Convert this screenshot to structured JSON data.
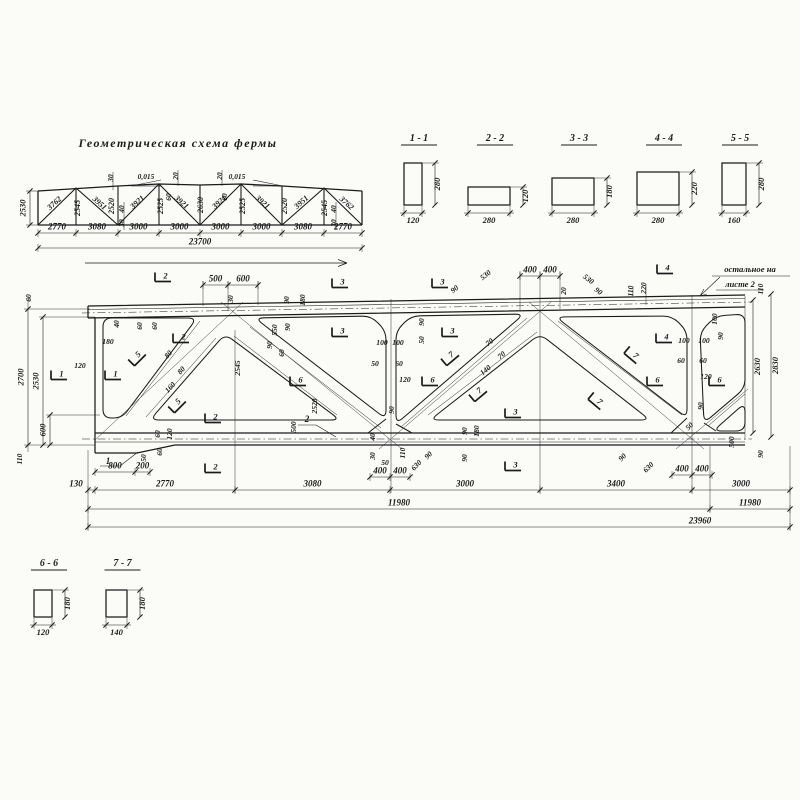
{
  "palette": {
    "paper": "#fbfbf8",
    "ink": "#1b1b1b"
  },
  "scheme": {
    "title": "Геометрическая схема фермы",
    "member_labels": [
      [
        "3762",
        56,
        205,
        -42
      ],
      [
        "2545",
        80,
        208,
        -90
      ],
      [
        "3951",
        98,
        205,
        42
      ],
      [
        "2520",
        114,
        206,
        -90
      ],
      [
        "3921",
        139,
        204,
        -42
      ],
      [
        "2525",
        163,
        206,
        -90
      ],
      [
        "3921",
        180,
        204,
        42
      ],
      [
        "2630",
        203,
        205,
        -90
      ],
      [
        "3921",
        221,
        204,
        -42
      ],
      [
        "2525",
        245,
        206,
        -90
      ],
      [
        "3921",
        261,
        204,
        42
      ],
      [
        "2520",
        287,
        206,
        -90
      ],
      [
        "3951",
        303,
        204,
        -42
      ],
      [
        "2545",
        327,
        208,
        -90
      ],
      [
        "3762",
        345,
        205,
        42
      ]
    ],
    "small_dims": [
      [
        "30",
        113,
        178,
        -90
      ],
      [
        "0,015",
        146,
        179
      ],
      [
        "20",
        178,
        176,
        -90
      ],
      [
        "60",
        171,
        197,
        -90
      ],
      [
        "20",
        222,
        176,
        -90
      ],
      [
        "0,015",
        237,
        179
      ],
      [
        "60",
        227,
        197,
        -90
      ],
      [
        "40",
        124,
        209,
        -90
      ],
      [
        "30",
        124,
        223,
        -90
      ],
      [
        "40",
        336,
        209,
        -90
      ],
      [
        "30",
        336,
        223,
        -90
      ]
    ],
    "dimrows": [
      {
        "y": 233,
        "ticks": [
          38,
          76,
          118,
          159,
          200,
          241,
          282,
          324,
          362
        ],
        "labels": [
          "2770",
          "3080",
          "3000",
          "3000",
          "3000",
          "3000",
          "3080",
          "2770"
        ]
      },
      {
        "y": 248,
        "ticks": [
          38,
          362
        ],
        "labels": [
          "23700"
        ]
      }
    ],
    "vdims": [
      {
        "x": 30,
        "y1": 191,
        "y2": 225,
        "t": "2530"
      }
    ]
  },
  "sections": [
    {
      "name": "1 - 1",
      "w": "120",
      "h": "280",
      "px": {
        "x": 404,
        "y": 163,
        "w": 18,
        "h": 42,
        "hx": 141
      }
    },
    {
      "name": "2 - 2",
      "w": "280",
      "h": "120",
      "px": {
        "x": 468,
        "y": 187,
        "w": 42,
        "h": 18,
        "hx": 141
      }
    },
    {
      "name": "3 - 3",
      "w": "280",
      "h": "180",
      "px": {
        "x": 552,
        "y": 178,
        "w": 42,
        "h": 27,
        "hx": 141
      }
    },
    {
      "name": "4 - 4",
      "w": "280",
      "h": "220",
      "px": {
        "x": 637,
        "y": 172,
        "w": 42,
        "h": 33,
        "hx": 141
      }
    },
    {
      "name": "5 - 5",
      "w": "160",
      "h": "280",
      "px": {
        "x": 722,
        "y": 163,
        "w": 24,
        "h": 42,
        "hx": 141
      }
    },
    {
      "name": "6 - 6",
      "w": "120",
      "h": "180",
      "px": {
        "x": 34,
        "y": 590,
        "w": 18,
        "h": 27,
        "hx": 566
      }
    },
    {
      "name": "7 - 7",
      "w": "140",
      "h": "180",
      "px": {
        "x": 106,
        "y": 590,
        "w": 21,
        "h": 27,
        "hx": 566
      }
    }
  ],
  "main": {
    "note1": "остальное на",
    "note2": "листе 2",
    "piece_marks": [
      [
        "1",
        108,
        464
      ],
      [
        "2",
        307,
        422
      ]
    ],
    "annotations": [
      [
        "30",
        233,
        299,
        -90
      ],
      [
        "530",
        487,
        277,
        -38
      ],
      [
        "90",
        456,
        291,
        -38
      ],
      [
        "530",
        587,
        281,
        38
      ],
      [
        "90",
        597,
        293,
        38
      ],
      [
        "20",
        566,
        291,
        -90
      ],
      [
        "110",
        633,
        291,
        -90
      ],
      [
        "220",
        646,
        288,
        -90
      ],
      [
        "110",
        763,
        289,
        -90
      ],
      [
        "60",
        31,
        298,
        -90
      ],
      [
        "90",
        289,
        300,
        -90
      ],
      [
        "180",
        305,
        300,
        -90
      ],
      [
        "40",
        119,
        324,
        -90
      ],
      [
        "60",
        142,
        326,
        -90
      ],
      [
        "60",
        157,
        326,
        -90
      ],
      [
        "180",
        108,
        344
      ],
      [
        "120",
        80,
        368
      ],
      [
        "80",
        170,
        356,
        -48
      ],
      [
        "80",
        183,
        372,
        -48
      ],
      [
        "160",
        172,
        389,
        -48
      ],
      [
        "2545",
        240,
        368,
        -90
      ],
      [
        "550",
        277,
        330,
        -90
      ],
      [
        "90",
        290,
        327,
        -90
      ],
      [
        "90",
        272,
        345,
        -90
      ],
      [
        "60",
        284,
        353,
        -90
      ],
      [
        "2520",
        317,
        406,
        -90
      ],
      [
        "500",
        296,
        427,
        -90
      ],
      [
        "50",
        146,
        458,
        -90
      ],
      [
        "60",
        162,
        452,
        -90
      ],
      [
        "60",
        160,
        434,
        -90
      ],
      [
        "120",
        172,
        434,
        -90
      ],
      [
        "110",
        22,
        459,
        -90
      ],
      [
        "90",
        424,
        322,
        -90
      ],
      [
        "50",
        424,
        340,
        -90
      ],
      [
        "100",
        382,
        345
      ],
      [
        "100",
        398,
        345
      ],
      [
        "50",
        375,
        366
      ],
      [
        "60",
        399,
        366
      ],
      [
        "120",
        405,
        382
      ],
      [
        "90",
        394,
        410,
        -90
      ],
      [
        "40",
        375,
        437,
        -90
      ],
      [
        "30",
        375,
        456,
        -90
      ],
      [
        "50",
        385,
        465
      ],
      [
        "110",
        405,
        453,
        -90
      ],
      [
        "630",
        418,
        467,
        -45
      ],
      [
        "90",
        430,
        457,
        -45
      ],
      [
        "70",
        491,
        344,
        -40
      ],
      [
        "70",
        503,
        357,
        -40
      ],
      [
        "140",
        487,
        372,
        -40
      ],
      [
        "90",
        467,
        431,
        -90
      ],
      [
        "180",
        479,
        431,
        -90
      ],
      [
        "90",
        467,
        458,
        -90
      ],
      [
        "100",
        684,
        343
      ],
      [
        "100",
        704,
        343
      ],
      [
        "100",
        717,
        319,
        -90
      ],
      [
        "90",
        723,
        336,
        -90
      ],
      [
        "60",
        681,
        363
      ],
      [
        "60",
        703,
        363
      ],
      [
        "120",
        706,
        379
      ],
      [
        "90",
        703,
        406,
        -90
      ],
      [
        "50",
        691,
        428,
        -45
      ],
      [
        "500",
        734,
        442,
        -90
      ],
      [
        "90",
        763,
        454,
        -90
      ],
      [
        "630",
        650,
        469,
        -45
      ],
      [
        "90",
        624,
        459,
        -45
      ]
    ],
    "flags": [
      [
        "2",
        163,
        277
      ],
      [
        "2",
        181,
        338
      ],
      [
        "2",
        213,
        418
      ],
      [
        "2",
        213,
        468
      ],
      [
        "3",
        340,
        283
      ],
      [
        "3",
        440,
        283
      ],
      [
        "3",
        340,
        332
      ],
      [
        "3",
        450,
        332
      ],
      [
        "3",
        513,
        413
      ],
      [
        "3",
        513,
        466
      ],
      [
        "4",
        665,
        269
      ],
      [
        "4",
        664,
        338
      ],
      [
        "1",
        59,
        375
      ],
      [
        "1",
        113,
        375
      ],
      [
        "5",
        137,
        357,
        -45
      ],
      [
        "5",
        177,
        404,
        -45
      ],
      [
        "6",
        298,
        381
      ],
      [
        "6",
        430,
        381
      ],
      [
        "6",
        655,
        381
      ],
      [
        "6",
        717,
        381
      ],
      [
        "7",
        450,
        357,
        -40
      ],
      [
        "7",
        478,
        393,
        -40
      ],
      [
        "7",
        597,
        401,
        40
      ],
      [
        "7",
        633,
        355,
        40
      ]
    ],
    "dimrows": [
      {
        "y": 285,
        "ticks": [
          203,
          228,
          258
        ],
        "labels": [
          "500",
          "600"
        ]
      },
      {
        "y": 276,
        "ticks": [
          520,
          540,
          560
        ],
        "labels": [
          "400",
          "400"
        ]
      },
      {
        "y": 477,
        "ticks": [
          370,
          390,
          410
        ],
        "labels": [
          "400",
          "400"
        ]
      },
      {
        "y": 475,
        "ticks": [
          672,
          692,
          712
        ],
        "labels": [
          "400",
          "400"
        ]
      },
      {
        "y": 472,
        "ticks": [
          95,
          135,
          150
        ],
        "labels": [
          "800",
          "200"
        ]
      },
      {
        "y": 490,
        "ticks": [
          88,
          95,
          235,
          390,
          540,
          692,
          790
        ],
        "labels": [
          {
            "t": "130",
            "x": 76
          },
          "2770",
          "3080",
          "3000",
          "3400",
          "3000"
        ]
      },
      {
        "y": 509,
        "ticks": [
          88,
          710,
          790
        ],
        "labels": [
          "11980",
          "11980"
        ]
      },
      {
        "y": 527,
        "ticks": [
          88,
          790
        ],
        "labels": [
          {
            "t": "23960",
            "x": 700
          }
        ]
      }
    ],
    "vdims": [
      {
        "x": 28,
        "y1": 309,
        "y2": 445,
        "t": "2700"
      },
      {
        "x": 43,
        "y1": 317,
        "y2": 445,
        "t": "2530"
      },
      {
        "x": 50,
        "y1": 415,
        "y2": 445,
        "t": "600"
      },
      {
        "x": 753,
        "y1": 300,
        "y2": 433,
        "t": "2630",
        "s": 1
      },
      {
        "x": 771,
        "y1": 294,
        "y2": 437,
        "t": "2830",
        "s": 1
      }
    ],
    "openings": [
      [
        [
          103,
          318
        ],
        [
          197,
          318
        ],
        [
          122,
          418
        ],
        [
          103,
          418
        ]
      ],
      [
        [
          225,
          334
        ],
        [
          340,
          420
        ],
        [
          150,
          420
        ]
      ],
      [
        [
          255,
          318
        ],
        [
          371,
          316
        ],
        [
          386,
          331
        ],
        [
          386,
          419
        ]
      ],
      [
        [
          396,
          331
        ],
        [
          411,
          316
        ],
        [
          524,
          314
        ],
        [
          396,
          424
        ]
      ],
      [
        [
          540,
          334
        ],
        [
          650,
          420
        ],
        [
          430,
          420
        ]
      ],
      [
        [
          556,
          317
        ],
        [
          672,
          316
        ],
        [
          687,
          331
        ],
        [
          687,
          418
        ]
      ],
      [
        [
          700,
          332
        ],
        [
          716,
          316
        ],
        [
          745,
          314
        ],
        [
          745,
          388
        ],
        [
          704,
          423
        ]
      ],
      [
        [
          713,
          431
        ],
        [
          745,
          403
        ],
        [
          745,
          431
        ]
      ]
    ]
  }
}
